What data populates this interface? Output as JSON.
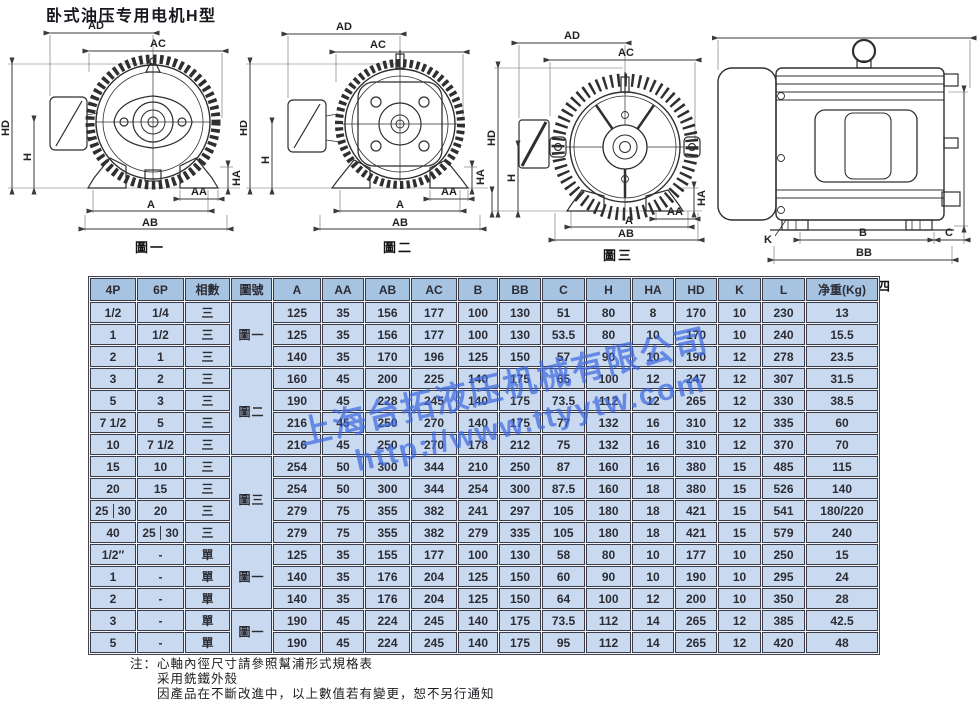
{
  "title": "卧式油压专用电机H型",
  "watermark": {
    "company": "上海台拓液压机械有限公司",
    "url": "http://www.ttyytw.com"
  },
  "colors": {
    "header_bg": "#a7c3e2",
    "cell_bg": "#c9daf0",
    "border": "#3c3c48",
    "watermark": "#3f6be0"
  },
  "figures": [
    {
      "caption": "圖一",
      "labels": {
        "ad": "AD",
        "ac": "AC",
        "hd": "HD",
        "h": "H",
        "ha": "HA",
        "aa": "AA",
        "a": "A",
        "ab": "AB"
      }
    },
    {
      "caption": "圖二",
      "labels": {
        "ad": "AD",
        "ac": "AC",
        "hd": "HD",
        "h": "H",
        "ha": "HA",
        "aa": "AA",
        "a": "A",
        "ab": "AB"
      }
    },
    {
      "caption": "圖三",
      "labels": {
        "ad": "AD",
        "ac": "AC",
        "hd": "HD",
        "h": "H",
        "ha": "HA",
        "aa": "AA",
        "a": "A",
        "ab": "AB"
      }
    },
    {
      "caption": "圖四",
      "labels": {
        "b": "B",
        "bb": "BB",
        "c": "C",
        "k": "K"
      }
    }
  ],
  "table": {
    "headers": [
      "4P",
      "6P",
      "相數",
      "圖號",
      "A",
      "AA",
      "AB",
      "AC",
      "B",
      "BB",
      "C",
      "H",
      "HA",
      "HD",
      "K",
      "L",
      "净重(Kg)"
    ],
    "figure_col": [
      {
        "row": 0,
        "label": "圖一",
        "span": 3
      },
      {
        "row": 3,
        "label": "圖二",
        "span": 4
      },
      {
        "row": 7,
        "label": "圖三",
        "span": 4
      },
      {
        "row": 11,
        "label": "圖一",
        "span": 3
      },
      {
        "row": 14,
        "label": "圖一",
        "span": 2
      }
    ],
    "rows": [
      [
        "1/2",
        "1/4",
        "三",
        "125",
        "35",
        "156",
        "177",
        "100",
        "130",
        "51",
        "80",
        "8",
        "170",
        "10",
        "230",
        "13"
      ],
      [
        "1",
        "1/2",
        "三",
        "125",
        "35",
        "156",
        "177",
        "100",
        "130",
        "53.5",
        "80",
        "10",
        "170",
        "10",
        "240",
        "15.5"
      ],
      [
        "2",
        "1",
        "三",
        "140",
        "35",
        "170",
        "196",
        "125",
        "150",
        "57",
        "90",
        "10",
        "190",
        "12",
        "278",
        "23.5"
      ],
      [
        "3",
        "2",
        "三",
        "160",
        "45",
        "200",
        "225",
        "140",
        "175",
        "65",
        "100",
        "12",
        "247",
        "12",
        "307",
        "31.5"
      ],
      [
        "5",
        "3",
        "三",
        "190",
        "45",
        "228",
        "245",
        "140",
        "175",
        "73.5",
        "112",
        "12",
        "265",
        "12",
        "330",
        "38.5"
      ],
      [
        "7 1/2",
        "5",
        "三",
        "216",
        "45",
        "250",
        "270",
        "140",
        "175",
        "77",
        "132",
        "16",
        "310",
        "12",
        "335",
        "60"
      ],
      [
        "10",
        "7 1/2",
        "三",
        "216",
        "45",
        "250",
        "270",
        "178",
        "212",
        "75",
        "132",
        "16",
        "310",
        "12",
        "370",
        "70"
      ],
      [
        "15",
        "10",
        "三",
        "254",
        "50",
        "300",
        "344",
        "210",
        "250",
        "87",
        "160",
        "16",
        "380",
        "15",
        "485",
        "115"
      ],
      [
        "20",
        "15",
        "三",
        "254",
        "50",
        "300",
        "344",
        "254",
        "300",
        "87.5",
        "160",
        "18",
        "380",
        "15",
        "526",
        "140"
      ],
      [
        "25|30",
        "20",
        "三",
        "279",
        "75",
        "355",
        "382",
        "241",
        "297",
        "105",
        "180",
        "18",
        "421",
        "15",
        "541",
        "180/220"
      ],
      [
        "40",
        "25|30",
        "三",
        "279",
        "75",
        "355",
        "382",
        "279",
        "335",
        "105",
        "180",
        "18",
        "421",
        "15",
        "579",
        "240"
      ],
      [
        "1/2″",
        "-",
        "單",
        "125",
        "35",
        "155",
        "177",
        "100",
        "130",
        "58",
        "80",
        "10",
        "177",
        "10",
        "250",
        "15"
      ],
      [
        "1",
        "-",
        "單",
        "140",
        "35",
        "176",
        "204",
        "125",
        "150",
        "60",
        "90",
        "10",
        "190",
        "10",
        "295",
        "24"
      ],
      [
        "2",
        "-",
        "單",
        "140",
        "35",
        "176",
        "204",
        "125",
        "150",
        "64",
        "100",
        "12",
        "200",
        "10",
        "350",
        "28"
      ],
      [
        "3",
        "-",
        "單",
        "190",
        "45",
        "224",
        "245",
        "140",
        "175",
        "73.5",
        "112",
        "14",
        "265",
        "12",
        "385",
        "42.5"
      ],
      [
        "5",
        "-",
        "單",
        "190",
        "45",
        "224",
        "245",
        "140",
        "175",
        "95",
        "112",
        "14",
        "265",
        "12",
        "420",
        "48"
      ]
    ]
  },
  "notes": {
    "prefix": "注：",
    "lines": [
      "心軸內徑尺寸請參照幫浦形式規格表",
      "采用銑鐵外殼",
      "因產品在不斷改進中，以上數值若有變更，恕不另行通知"
    ]
  }
}
